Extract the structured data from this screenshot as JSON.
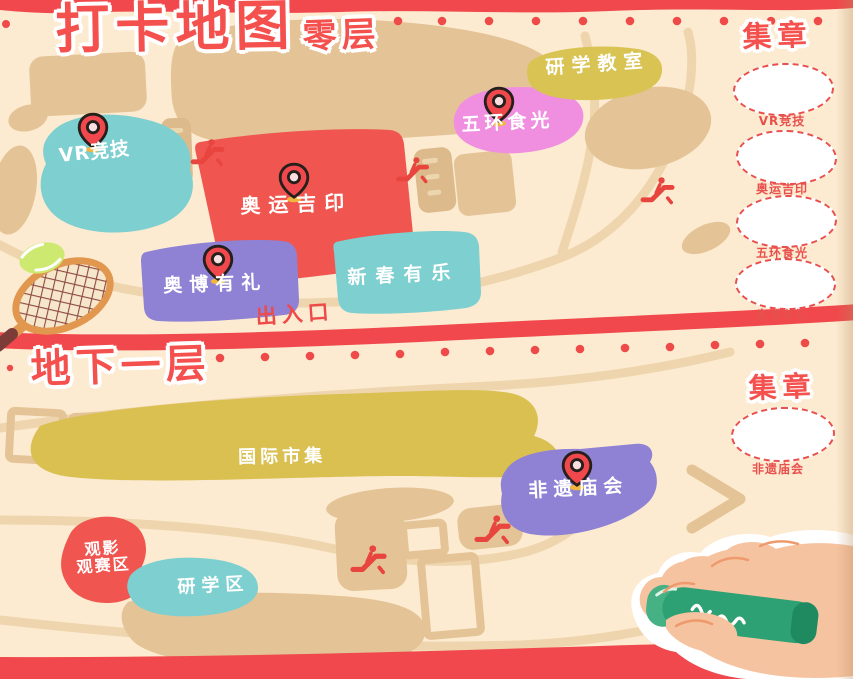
{
  "header": {
    "title": "打卡地图",
    "floor_tag": "零层"
  },
  "floor0": {
    "regions": {
      "vr": "VR竞技",
      "jiyin": "奥运吉印",
      "youli": "奥博有礼",
      "youle": "新春有乐",
      "shiguang": "五环食光",
      "jiaoshi": "研学教室"
    },
    "entrance": "出入口",
    "stamps": {
      "title": "集章",
      "items": [
        "VR竞技",
        "奥运吉印",
        "五环食光",
        "奥博有礼"
      ]
    }
  },
  "b1": {
    "title": "地下一层",
    "regions": {
      "shiji": "国际市集",
      "miaohui": "非遗庙会",
      "guanying1": "观影",
      "guanying2": "观赛区",
      "yanxue": "研学区"
    },
    "stamps": {
      "title": "集章",
      "items": [
        "非遗庙会"
      ]
    }
  },
  "colors": {
    "accent_red": "#f0484c",
    "region_red": "#f0564f",
    "teal": "#7ecfd0",
    "purple": "#8f82d5",
    "pink": "#f08fe0",
    "olive": "#d8c353",
    "yellow": "#d9c050",
    "tan": "#e4c496",
    "cream": "#fcebd1",
    "crayon_green": "#2da173"
  }
}
